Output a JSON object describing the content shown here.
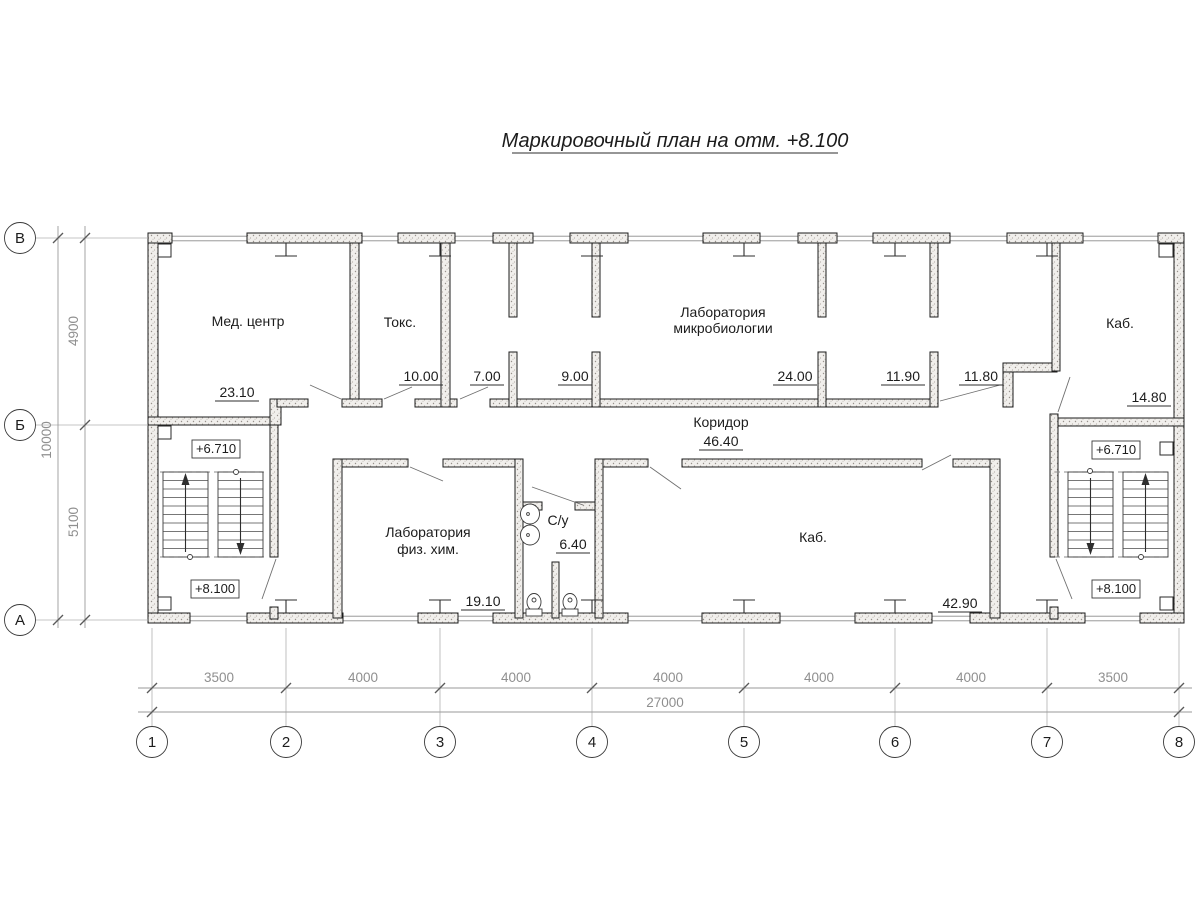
{
  "title": "Маркировочный план на отм. +8.100",
  "axes": {
    "cols": [
      "1",
      "2",
      "3",
      "4",
      "5",
      "6",
      "7",
      "8"
    ],
    "rows": [
      "В",
      "Б",
      "А"
    ]
  },
  "dims": {
    "col_spans": [
      "3500",
      "4000",
      "4000",
      "4000",
      "4000",
      "4000",
      "3500"
    ],
    "col_total": "27000",
    "row_spans": [
      "4900",
      "5100"
    ],
    "row_total": "10000"
  },
  "elevations": {
    "landing": "+6.710",
    "floor": "+8.100"
  },
  "rooms": {
    "med_center": {
      "name": "Мед. центр",
      "area": "23.10"
    },
    "toks": {
      "name": "Токс.",
      "area": "10.00"
    },
    "room_7": {
      "area": "7.00"
    },
    "room_9": {
      "area": "9.00"
    },
    "micro_lab": {
      "name_line1": "Лаборатория",
      "name_line2": "микробиологии",
      "area": "24.00"
    },
    "room_11_90": {
      "area": "11.90"
    },
    "room_11_80": {
      "area": "11.80"
    },
    "kab_top_right": {
      "name": "Каб.",
      "area": "14.80"
    },
    "corridor": {
      "name": "Коридор",
      "area": "46.40"
    },
    "fizhim_lab": {
      "name_line1": "Лаборатория",
      "name_line2": "физ. хим.",
      "area": "19.10"
    },
    "sanitary": {
      "name": "С/у",
      "area": "6.40"
    },
    "kab_bottom": {
      "name": "Каб.",
      "area": "42.90"
    }
  }
}
